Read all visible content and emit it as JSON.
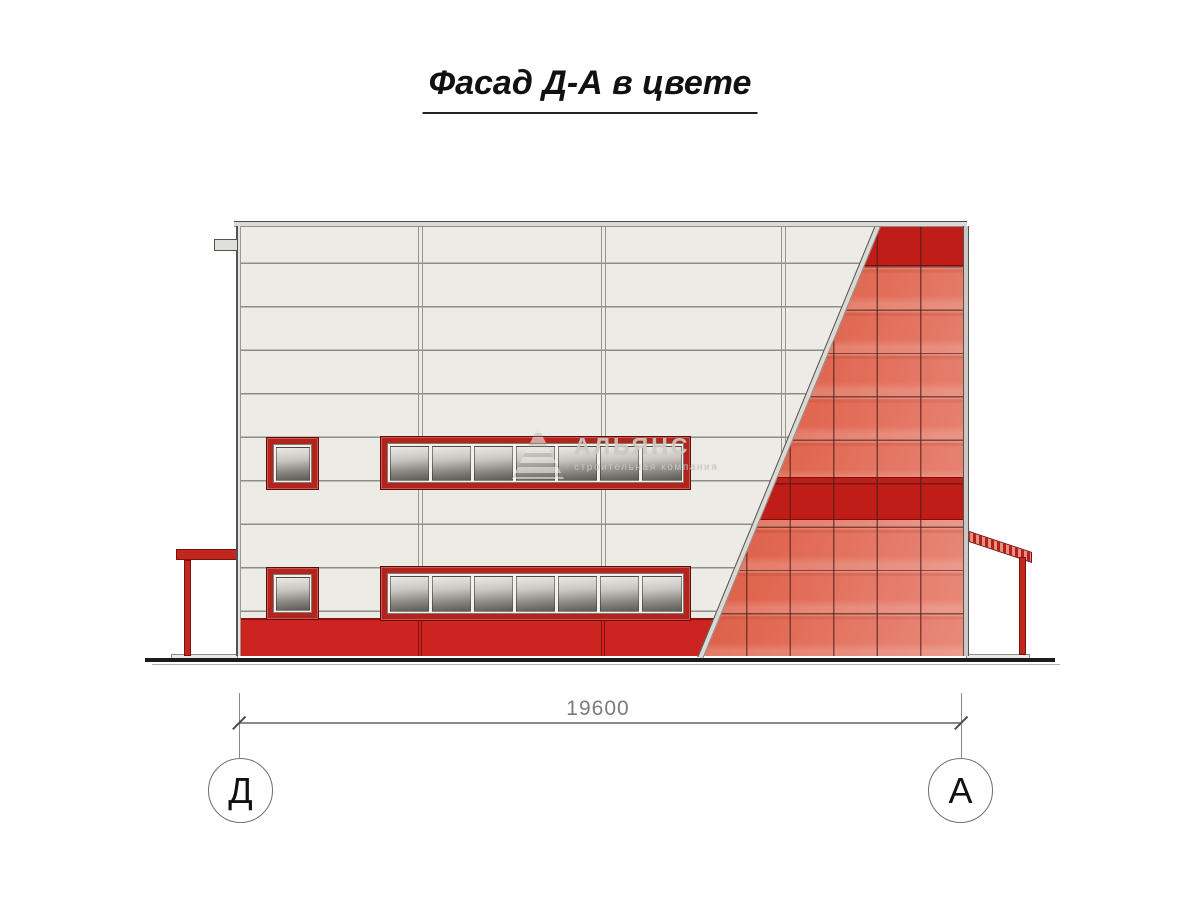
{
  "title": {
    "text": "Фасад Д-А в цвете"
  },
  "dimension": {
    "value": "19600"
  },
  "axes": {
    "left_label": "Д",
    "right_label": "А"
  },
  "watermark": {
    "company": "АЛЬЯНС",
    "tagline": "строительная компания"
  },
  "colors": {
    "accent_dark_red": "#c01d18",
    "panel_red": "#dd604f",
    "plinth_red": "#cc2420",
    "window_frame_red": "#b3241c",
    "facade_white": "#edebe6",
    "glass_dark": "#5d5954",
    "drawing_line_gray": "#8a8a86",
    "ground_black": "#1c1c1a"
  }
}
